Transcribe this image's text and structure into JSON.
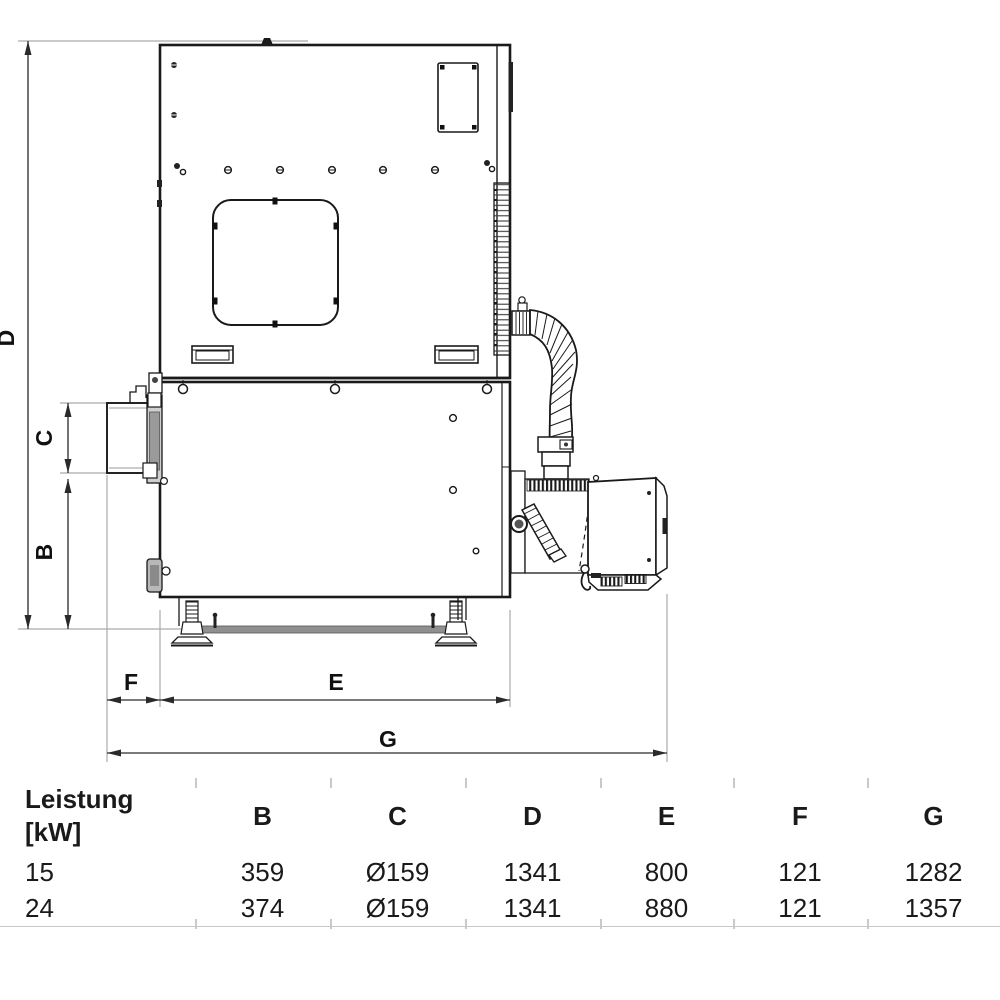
{
  "drawing": {
    "title": "boiler-side-view-technical-drawing",
    "dim_labels": {
      "b": "B",
      "c": "C",
      "d": "D",
      "e": "E",
      "f": "F",
      "g": "G"
    },
    "colors": {
      "line": "#1a1a1a",
      "dim_line": "#2a2a2a",
      "extension_line": "#ababab",
      "metal_gray": "#9a9a9a",
      "bar_gray": "#8f8f8f"
    }
  },
  "table": {
    "header": {
      "power_label_line1": "Leistung",
      "power_label_line2": "[kW]",
      "cols": [
        "B",
        "C",
        "D",
        "E",
        "F",
        "G"
      ]
    },
    "rows": [
      {
        "power": "15",
        "b": "359",
        "c": "Ø159",
        "d": "1341",
        "e": "800",
        "f": "121",
        "g": "1282"
      },
      {
        "power": "24",
        "b": "374",
        "c": "Ø159",
        "d": "1341",
        "e": "880",
        "f": "121",
        "g": "1357"
      }
    ]
  }
}
